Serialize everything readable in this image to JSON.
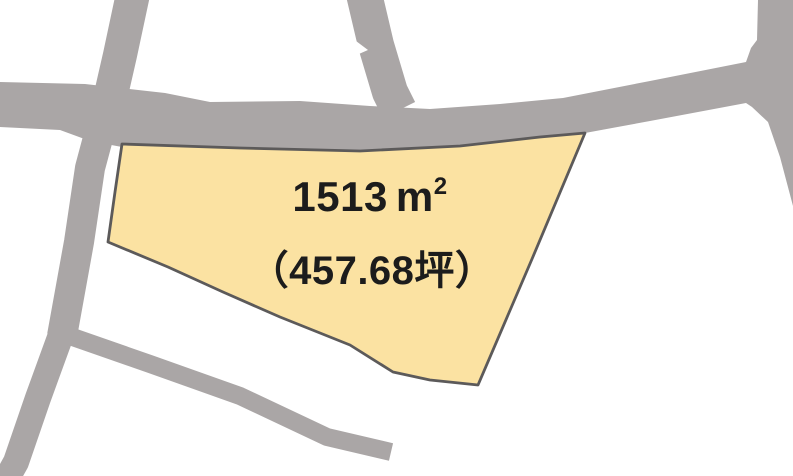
{
  "map": {
    "background_color": "#FFFFFF",
    "road_color": "#AAA6A6",
    "text_color": "#1C1C1C",
    "parcel": {
      "fill": "#FBE2A2",
      "outline_color": "#5C5A5A",
      "area_value": "1513",
      "area_unit": "m",
      "area_exponent": "2",
      "tsubo_label": "（457.68坪）"
    }
  }
}
